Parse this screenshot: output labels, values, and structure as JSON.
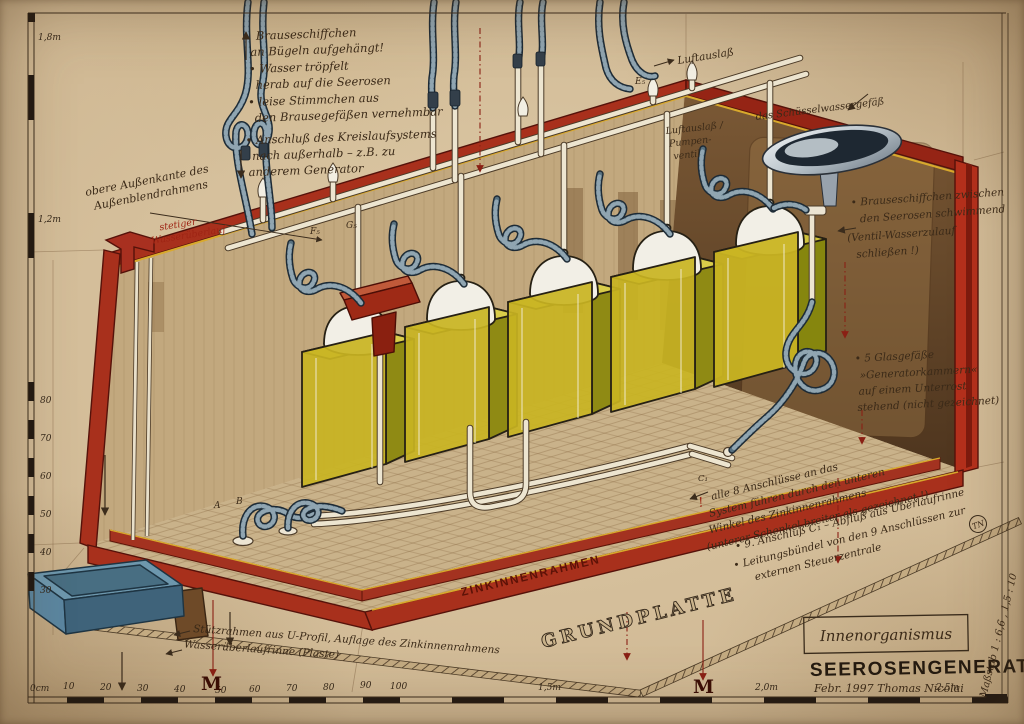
{
  "artwork": {
    "title": "SEEROSENGENERATOR",
    "credit": "Febr. 1997   Thomas Nicolai",
    "box_label": "Innenorganismus",
    "scale_note": "Maßstab  1 : 6,6̄ ,  1,5 : 10",
    "monogram": "TN"
  },
  "annotations": {
    "top_left": [
      "Brauseschiffchen",
      "an Bügeln aufgehängt!",
      "• Wasser tröpfelt",
      "herab auf die Seerosen",
      "• leise Stimmchen aus",
      "den Brausegefäßen vernehmbar",
      "• Anschluß des Kreislaufsystems",
      "nach außerhalb – z.B. zu",
      "anderem Generator"
    ],
    "outer_edge": [
      "obere Außenkante des",
      "Außenblendrahmens"
    ],
    "overflow_red": [
      "stetiger",
      "Wasserüberlauf"
    ],
    "air_outlet_top": "Luftauslaß",
    "air_valve": [
      "Luftauslaß /",
      "Pumpen-",
      "ventil"
    ],
    "bowl": "das Schüsselwassergefäß",
    "float_boats": [
      "• Brauseschiffchen zwischen",
      "den Seerosen schwimmend",
      "(Ventil-Wasserzulauf",
      "schließen !)"
    ],
    "glass_vessels": [
      "• 5 Glasgefäße",
      "»Generatorkammern«",
      "auf einem Unterrost",
      "stehend (nicht gezeichnet)"
    ],
    "attention": "!",
    "connections": [
      "alle 8 Anschlüsse an das",
      "System führen durch den unteren",
      "Winkel des Zinkinnenrahmens",
      "(unterer Schenkel breiter als gezeichnet !)"
    ],
    "drain": [
      "• 9. Anschluß C₁ – Abfluß aus Überlaufrinne",
      "• Leitungsbündel von den 9 Anschlüssen zur",
      "externen Steuerzentrale"
    ],
    "support_frame": [
      "Stützrahmen aus U-Profil, Auflage des Zinkinnenrahmens",
      "Wasserüberlaufrinne (Plaste)"
    ],
    "zinc_frame": "ZINKINNENRAHMEN",
    "base_plate": "GRUNDPLATTE"
  },
  "labels": {
    "e5": "E₅",
    "f5": "F₅",
    "g5": "G₅",
    "a": "A",
    "b": "B",
    "c1": "C₁"
  },
  "rulers": {
    "left": {
      "top_marks": [
        "1,8m",
        "1,2m"
      ],
      "cm_marks": [
        "80",
        "70",
        "60",
        "50",
        "40",
        "30"
      ]
    },
    "bottom": {
      "cm_marks": [
        "0cm",
        "10",
        "20",
        "30",
        "40",
        "50",
        "60",
        "70",
        "80",
        "90",
        "100"
      ],
      "m_marks": [
        "1,5m",
        "2,0m",
        "2,5m"
      ],
      "marker": "M"
    }
  },
  "colors": {
    "paper": "#cdb590",
    "frame_red": "#a8301c",
    "frame_red_bright": "#b5301c",
    "trim_yellow": "#d9a92c",
    "tank_yellow": "#c9b422",
    "tank_yellow_dark": "#8f8a14",
    "tank_yellow_top": "#d9cc4a",
    "hose_blue": "#57707f",
    "pipe_cream": "#ede5d0",
    "ink": "#3b2a18",
    "ink_red": "#9e2414",
    "bowl_silver": "#c3ccd2",
    "tray_blue": "#5b86a0",
    "wall_dark": "#6b4a2c"
  }
}
